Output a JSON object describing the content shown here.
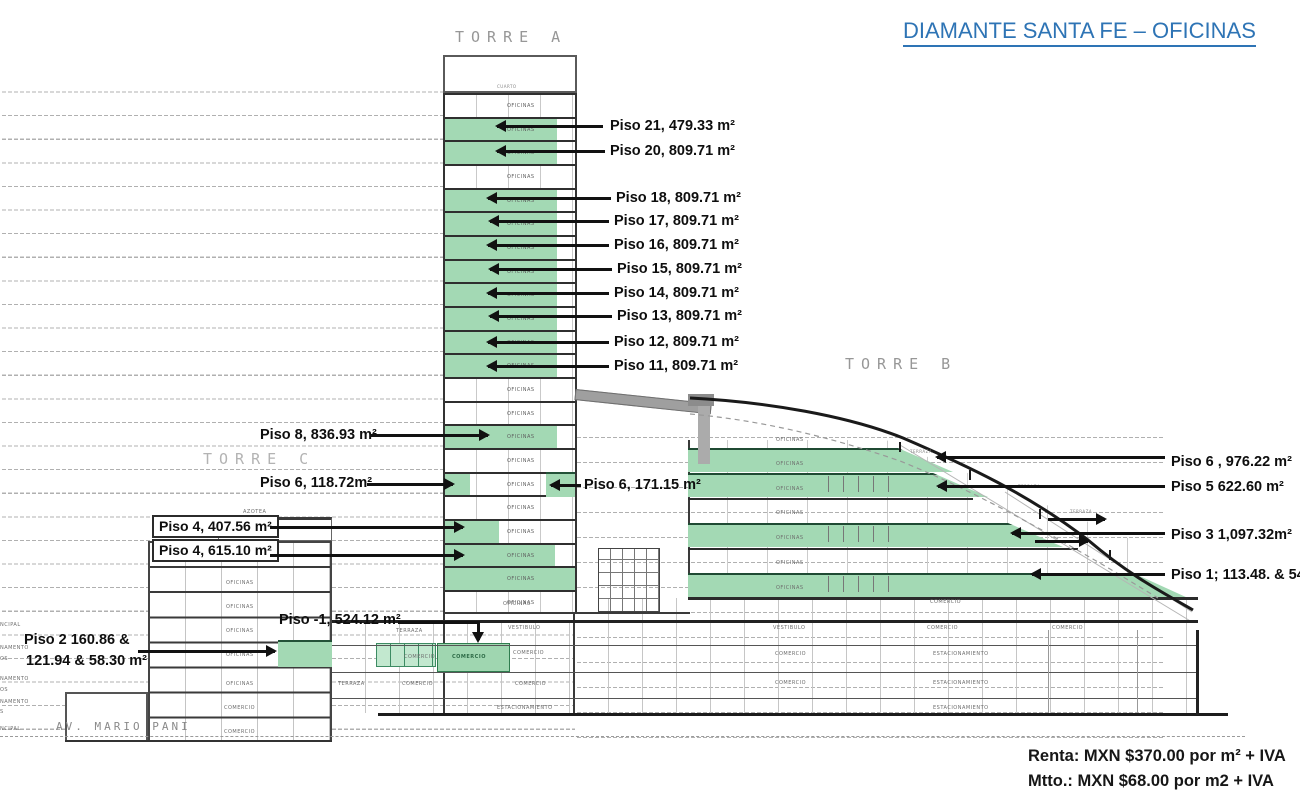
{
  "title": {
    "text": "DIAMANTE SANTA FE – OFICINAS",
    "color": "#2e74b5"
  },
  "pricing": {
    "line1": "Renta: MXN $370.00 por m² + IVA",
    "line2": "Mtto.: MXN $68.00 por m2 + IVA"
  },
  "street": "AV. MARIO PANI",
  "towers": {
    "a": "TORRE A",
    "b": "TORRE B",
    "c": "TORRE C"
  },
  "colors": {
    "accent_green": "#a3d9b4",
    "slab": "#2b2b2b",
    "title_blue": "#2e74b5",
    "dash_gray": "#b0b0b0"
  },
  "ann": {
    "p21": "Piso 21, 479.33 m²",
    "p20": "Piso 20, 809.71 m²",
    "p18": "Piso 18, 809.71 m²",
    "p17": "Piso 17, 809.71 m²",
    "p16": "Piso 16, 809.71 m²",
    "p15": "Piso 15, 809.71 m²",
    "p14": "Piso 14, 809.71 m²",
    "p13": "Piso 13, 809.71 m²",
    "p12": "Piso 12, 809.71 m²",
    "p11": "Piso 11, 809.71 m²",
    "p8": "Piso 8, 836.93 m²",
    "p6a": "Piso 6, 118.72m²",
    "p6b": "Piso 6, 171.15 m²",
    "p4a": "Piso 4, 407.56 m²",
    "p4b": "Piso 4, 615.10 m²",
    "pm1": "Piso -1, 524.12 m²",
    "p2l1": "Piso 2 160.86 &",
    "p2l2": "121.94 & 58.30 m²",
    "p6r": "Piso 6 , 976.22  m²",
    "p5r": "Piso 5  622.60 m²",
    "p3r": "Piso 3 1,097.32m²",
    "p1r": "Piso 1; 113.48. & 543"
  },
  "torreA": {
    "floors": [
      {
        "label": "OFICINAS"
      },
      {
        "label": "OFICINAS",
        "green": true,
        "gw": 112
      },
      {
        "label": "OFICINAS",
        "green": true,
        "gw": 112
      },
      {
        "label": "OFICINAS"
      },
      {
        "label": "OFICINAS",
        "green": true,
        "gw": 112
      },
      {
        "label": "OFICINAS",
        "green": true,
        "gw": 112
      },
      {
        "label": "OFICINAS",
        "green": true,
        "gw": 112
      },
      {
        "label": "OFICINAS",
        "green": true,
        "gw": 112
      },
      {
        "label": "OFICINAS",
        "green": true,
        "gw": 112
      },
      {
        "label": "OFICINAS",
        "green": true,
        "gw": 112
      },
      {
        "label": "OFICINAS",
        "green": true,
        "gw": 112
      },
      {
        "label": "OFICINAS",
        "green": true,
        "gw": 112
      },
      {
        "label": "OFICINAS"
      },
      {
        "label": "OFICINAS"
      },
      {
        "label": "OFICINAS",
        "green": true,
        "gw": 112
      },
      {
        "label": "OFICINAS"
      },
      {
        "label": "OFICINAS",
        "green": true,
        "gw": 25
      },
      {
        "label": "OFICINAS"
      },
      {
        "label": "OFICINAS",
        "green": true,
        "gw": 54
      },
      {
        "label": "OFICINAS",
        "green": true,
        "gw": 110
      },
      {
        "label": "OFICINAS",
        "green": true,
        "gw": 130
      },
      {
        "label": "OFICINAS"
      }
    ]
  },
  "tiny_labels": [
    {
      "t": "CUARTO",
      "x": 497,
      "y": 84,
      "cls": "xs"
    },
    {
      "t": "AZOTEA",
      "x": 243,
      "y": 509
    },
    {
      "t": "AZOTEA",
      "x": 220,
      "y": 533
    },
    {
      "t": "OFICINAS",
      "x": 226,
      "y": 556
    },
    {
      "t": "OFICINAS",
      "x": 226,
      "y": 580
    },
    {
      "t": "OFICINAS",
      "x": 226,
      "y": 604
    },
    {
      "t": "OFICINAS",
      "x": 226,
      "y": 628
    },
    {
      "t": "OFICINAS",
      "x": 226,
      "y": 652
    },
    {
      "t": "OFICINAS",
      "x": 226,
      "y": 681
    },
    {
      "t": "COMERCIO",
      "x": 224,
      "y": 705
    },
    {
      "t": "COMERCIO",
      "x": 224,
      "y": 729
    },
    {
      "t": "TERRAZA",
      "x": 338,
      "y": 681
    },
    {
      "t": "OFICINAS",
      "x": 776,
      "y": 437
    },
    {
      "t": "OFICINAS",
      "x": 776,
      "y": 461
    },
    {
      "t": "OFICINAS",
      "x": 776,
      "y": 486
    },
    {
      "t": "OFICINAS",
      "x": 776,
      "y": 510
    },
    {
      "t": "OFICINAS",
      "x": 776,
      "y": 535
    },
    {
      "t": "OFICINAS",
      "x": 776,
      "y": 560
    },
    {
      "t": "OFICINAS",
      "x": 776,
      "y": 585
    },
    {
      "t": "TERRAZA",
      "x": 910,
      "y": 449,
      "cls": "xs"
    },
    {
      "t": "TERRAZA",
      "x": 1018,
      "y": 484,
      "cls": "xs"
    },
    {
      "t": "TERRAZA",
      "x": 1070,
      "y": 509,
      "cls": "xs"
    },
    {
      "t": "OFICINAS",
      "x": 503,
      "y": 601
    },
    {
      "t": "TERRAZA",
      "x": 396,
      "y": 628
    },
    {
      "t": "VESTIBULO",
      "x": 508,
      "y": 625
    },
    {
      "t": "COMERCIO",
      "x": 404,
      "y": 654
    },
    {
      "t": "COMERCIO",
      "x": 402,
      "y": 681
    },
    {
      "t": "COMERCIO",
      "x": 513,
      "y": 650
    },
    {
      "t": "COMERCIO",
      "x": 515,
      "y": 681
    },
    {
      "t": "ESTACIONAMIENTO",
      "x": 497,
      "y": 705
    },
    {
      "t": "COMERCIO",
      "x": 452,
      "y": 654,
      "cls": "ong"
    },
    {
      "t": "VESTIBULO",
      "x": 773,
      "y": 625
    },
    {
      "t": "COMERCIO",
      "x": 775,
      "y": 651
    },
    {
      "t": "COMERCIO",
      "x": 775,
      "y": 680
    },
    {
      "t": "COMERCIO",
      "x": 930,
      "y": 599
    },
    {
      "t": "COMERCIO",
      "x": 927,
      "y": 625
    },
    {
      "t": "ESTACIONAMIENTO",
      "x": 933,
      "y": 651
    },
    {
      "t": "ESTACIONAMIENTO",
      "x": 933,
      "y": 680
    },
    {
      "t": "ESTACIONAMIENTO",
      "x": 933,
      "y": 705
    },
    {
      "t": "COMERCIO",
      "x": 1052,
      "y": 625
    },
    {
      "t": "NCIPAL",
      "x": 0,
      "y": 622
    },
    {
      "t": "NAMENTO",
      "x": 0,
      "y": 645
    },
    {
      "t": "OS",
      "x": 0,
      "y": 656
    },
    {
      "t": "NAMENTO",
      "x": 0,
      "y": 676
    },
    {
      "t": "OS",
      "x": 0,
      "y": 687
    },
    {
      "t": "NAMENTO",
      "x": 0,
      "y": 699
    },
    {
      "t": "S",
      "x": 0,
      "y": 709
    },
    {
      "t": "NCIPAL",
      "x": 0,
      "y": 726
    }
  ]
}
